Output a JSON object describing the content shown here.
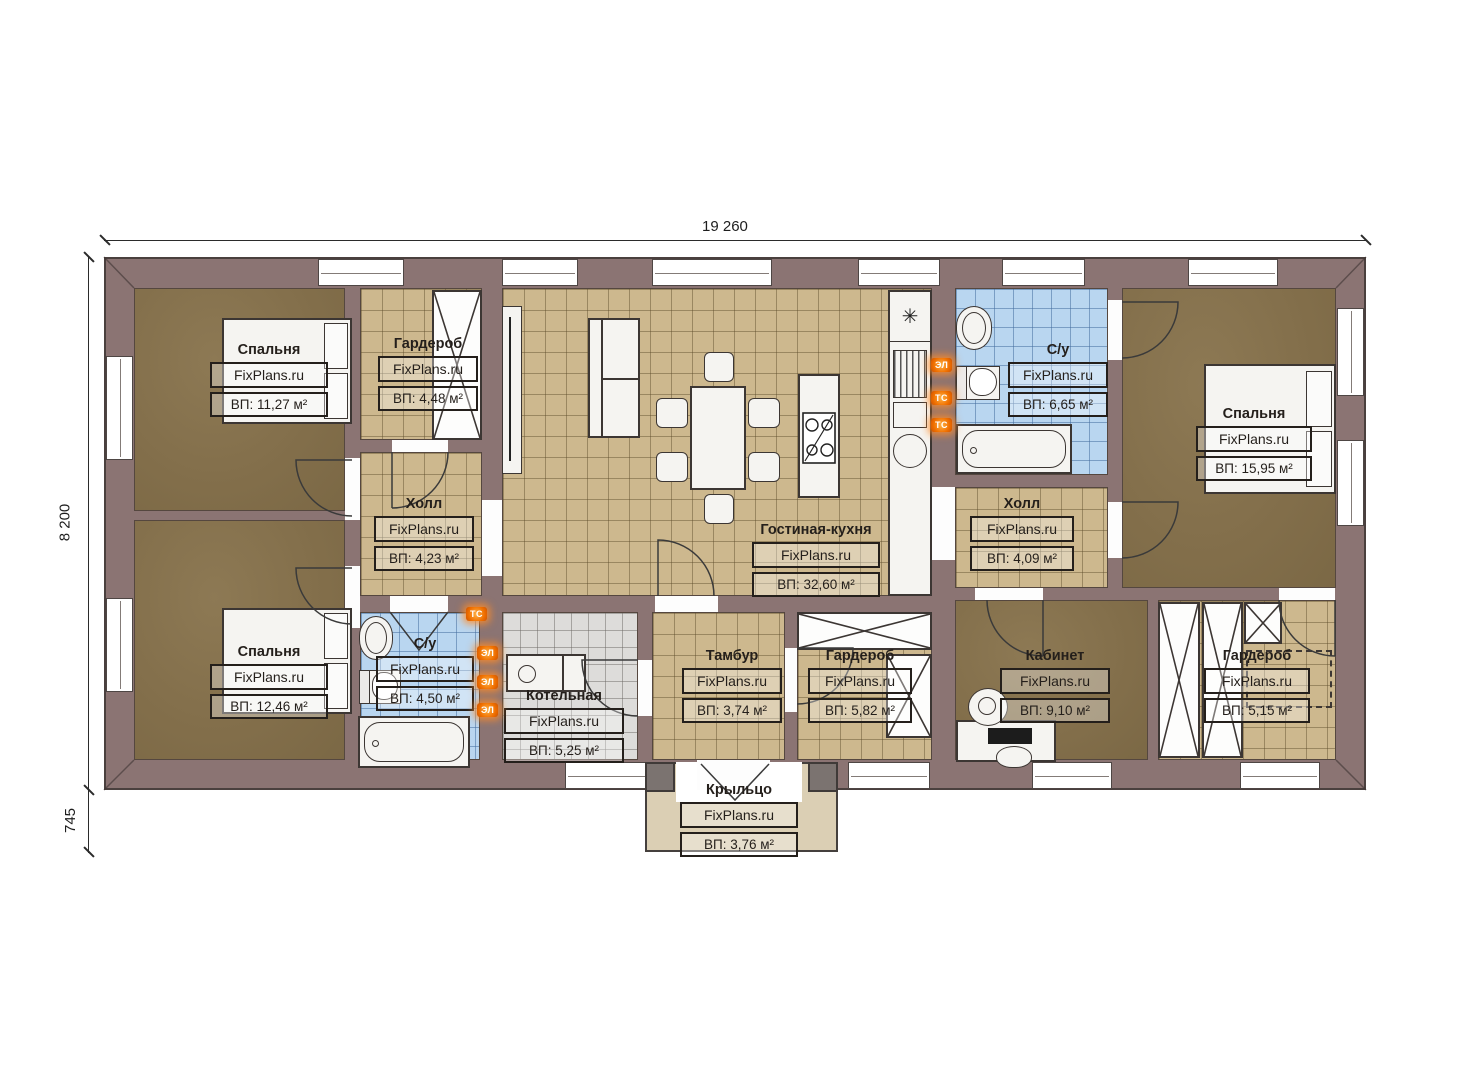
{
  "dimensions": {
    "top": "19 260",
    "left": "8 200",
    "left_lower": "745"
  },
  "rooms": [
    {
      "name": "Спальня",
      "watermark": "FixPlans.ru",
      "area": "ВП: 11,27 м²"
    },
    {
      "name": "Гардероб",
      "watermark": "FixPlans.ru",
      "area": "ВП: 4,48 м²"
    },
    {
      "name": "Холл",
      "watermark": "FixPlans.ru",
      "area": "ВП: 4,23 м²"
    },
    {
      "name": "Гостиная-кухня",
      "watermark": "FixPlans.ru",
      "area": "ВП: 32,60 м²"
    },
    {
      "name": "С/у",
      "watermark": "FixPlans.ru",
      "area": "ВП: 6,65 м²"
    },
    {
      "name": "Холл",
      "watermark": "FixPlans.ru",
      "area": "ВП: 4,09 м²"
    },
    {
      "name": "Спальня",
      "watermark": "FixPlans.ru",
      "area": "ВП: 15,95 м²"
    },
    {
      "name": "Спальня",
      "watermark": "FixPlans.ru",
      "area": "ВП: 12,46 м²"
    },
    {
      "name": "С/у",
      "watermark": "FixPlans.ru",
      "area": "ВП: 4,50 м²"
    },
    {
      "name": "Котельная",
      "watermark": "FixPlans.ru",
      "area": "ВП: 5,25 м²"
    },
    {
      "name": "Тамбур",
      "watermark": "FixPlans.ru",
      "area": "ВП: 3,74 м²"
    },
    {
      "name": "Гардероб",
      "watermark": "FixPlans.ru",
      "area": "ВП: 5,82 м²"
    },
    {
      "name": "Кабинет",
      "watermark": "FixPlans.ru",
      "area": "ВП: 9,10 м²"
    },
    {
      "name": "Гардероб",
      "watermark": "FixPlans.ru",
      "area": "ВП: 5,15 м²"
    },
    {
      "name": "Крыльцо",
      "watermark": "FixPlans.ru",
      "area": "ВП: 3,76 м²"
    }
  ],
  "utility_icons": {
    "left_wall": [
      "ТС",
      "ЭЛ",
      "ЭЛ",
      "ЭЛ"
    ],
    "kitchen_wall": [
      "ЭЛ",
      "ТС",
      "ТС"
    ]
  },
  "icons": {
    "fridge": "✳"
  },
  "colors": {
    "wall": "#8b7473",
    "floor_tile_tan": "#cdb88e",
    "floor_tile_blue": "#b9d6f0",
    "floor_tile_gray": "#dddcda",
    "floor_bedroom": "#847049",
    "floor_porch": "#dbcfb4",
    "utility_orange": "#f07000"
  }
}
